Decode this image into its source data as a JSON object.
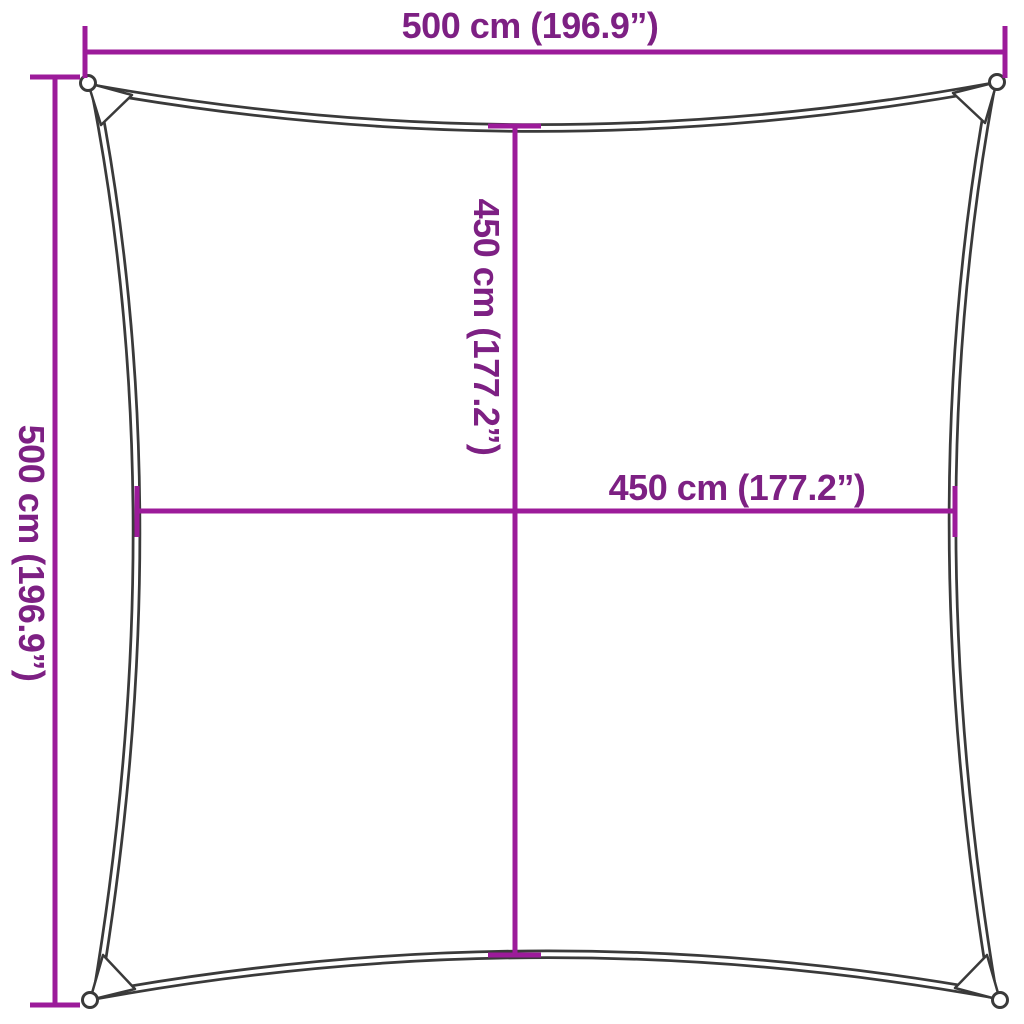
{
  "colors": {
    "background": "#ffffff",
    "dimension_line": "#9c1b9a",
    "dimension_text": "#7d2083",
    "sail_outline": "#3a3a3a"
  },
  "figure": {
    "type": "product-dimension-diagram",
    "subject": "square shade sail, concave edges, grommet ring at each corner",
    "outer_width": "500 cm (196.9”)",
    "outer_height": "500 cm (196.9”)",
    "inner_width": "450 cm (177.2”)",
    "inner_height": "450 cm (177.2”)"
  },
  "labels": {
    "top_width": "500 cm (196.9”)",
    "left_height": "500 cm (196.9”)",
    "inner_height": "450 cm (177.2”)",
    "inner_width": "450 cm (177.2”)"
  }
}
